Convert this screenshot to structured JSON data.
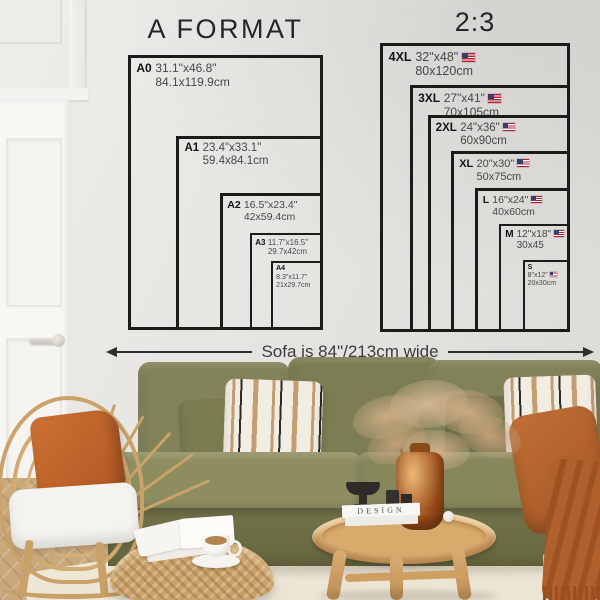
{
  "page": {
    "charts": [
      {
        "id": "a-format",
        "title": "A FORMAT",
        "sizes": [
          {
            "code": "A0",
            "inches": "31.1\"x46.8\"",
            "cm": "84.1x119.9cm",
            "w_in": 31.1,
            "h_in": 46.8,
            "flag": false,
            "stacked": false
          },
          {
            "code": "A1",
            "inches": "23.4\"x33.1\"",
            "cm": "59.4x84.1cm",
            "w_in": 23.4,
            "h_in": 33.1,
            "flag": false,
            "stacked": false
          },
          {
            "code": "A2",
            "inches": "16.5\"x23.4\"",
            "cm": "42x59.4cm",
            "w_in": 16.5,
            "h_in": 23.4,
            "flag": false,
            "stacked": false
          },
          {
            "code": "A3",
            "inches": "11.7\"x16.5\"",
            "cm": "29.7x42cm",
            "w_in": 11.7,
            "h_in": 16.5,
            "flag": false,
            "stacked": false
          },
          {
            "code": "A4",
            "inches": "8.3\"x11.7\"",
            "cm": "21x29.7cm",
            "w_in": 8.3,
            "h_in": 11.7,
            "flag": false,
            "stacked": true
          }
        ]
      },
      {
        "id": "ratio-2-3",
        "title": "2:3",
        "sizes": [
          {
            "code": "4XL",
            "inches": "32\"x48\"",
            "cm": "80x120cm",
            "w_in": 32,
            "h_in": 48,
            "flag": true,
            "stacked": false
          },
          {
            "code": "3XL",
            "inches": "27\"x41\"",
            "cm": "70x105cm",
            "w_in": 27,
            "h_in": 41,
            "flag": true,
            "stacked": false
          },
          {
            "code": "2XL",
            "inches": "24\"x36\"",
            "cm": "60x90cm",
            "w_in": 24,
            "h_in": 36,
            "flag": true,
            "stacked": false
          },
          {
            "code": "XL",
            "inches": "20\"x30\"",
            "cm": "50x75cm",
            "w_in": 20,
            "h_in": 30,
            "flag": true,
            "stacked": false
          },
          {
            "code": "L",
            "inches": "16\"x24\"",
            "cm": "40x60cm",
            "w_in": 16,
            "h_in": 24,
            "flag": true,
            "stacked": false
          },
          {
            "code": "M",
            "inches": "12\"x18\"",
            "cm": "30x45",
            "w_in": 12,
            "h_in": 18,
            "flag": true,
            "stacked": false
          },
          {
            "code": "S",
            "inches": "8\"x12\"",
            "cm": "20x30cm",
            "w_in": 8,
            "h_in": 12,
            "flag": true,
            "stacked": true
          }
        ]
      }
    ],
    "sofa_note": "Sofa is 84\"/213cm wide",
    "decor": {
      "book_spine": "DESIGN"
    },
    "colors": {
      "line": "#1b1b1b",
      "wall": "#e7e5e1",
      "sofa_olive": "#81814f",
      "pillow_rust": "#c4692f",
      "throw_rust": "#b2622c",
      "wood_light": "#dcae72",
      "rattan": "#cfa96f",
      "rug": "#ece5d5",
      "flag_red": "#b22234",
      "flag_blue": "#3c3b6e"
    }
  }
}
